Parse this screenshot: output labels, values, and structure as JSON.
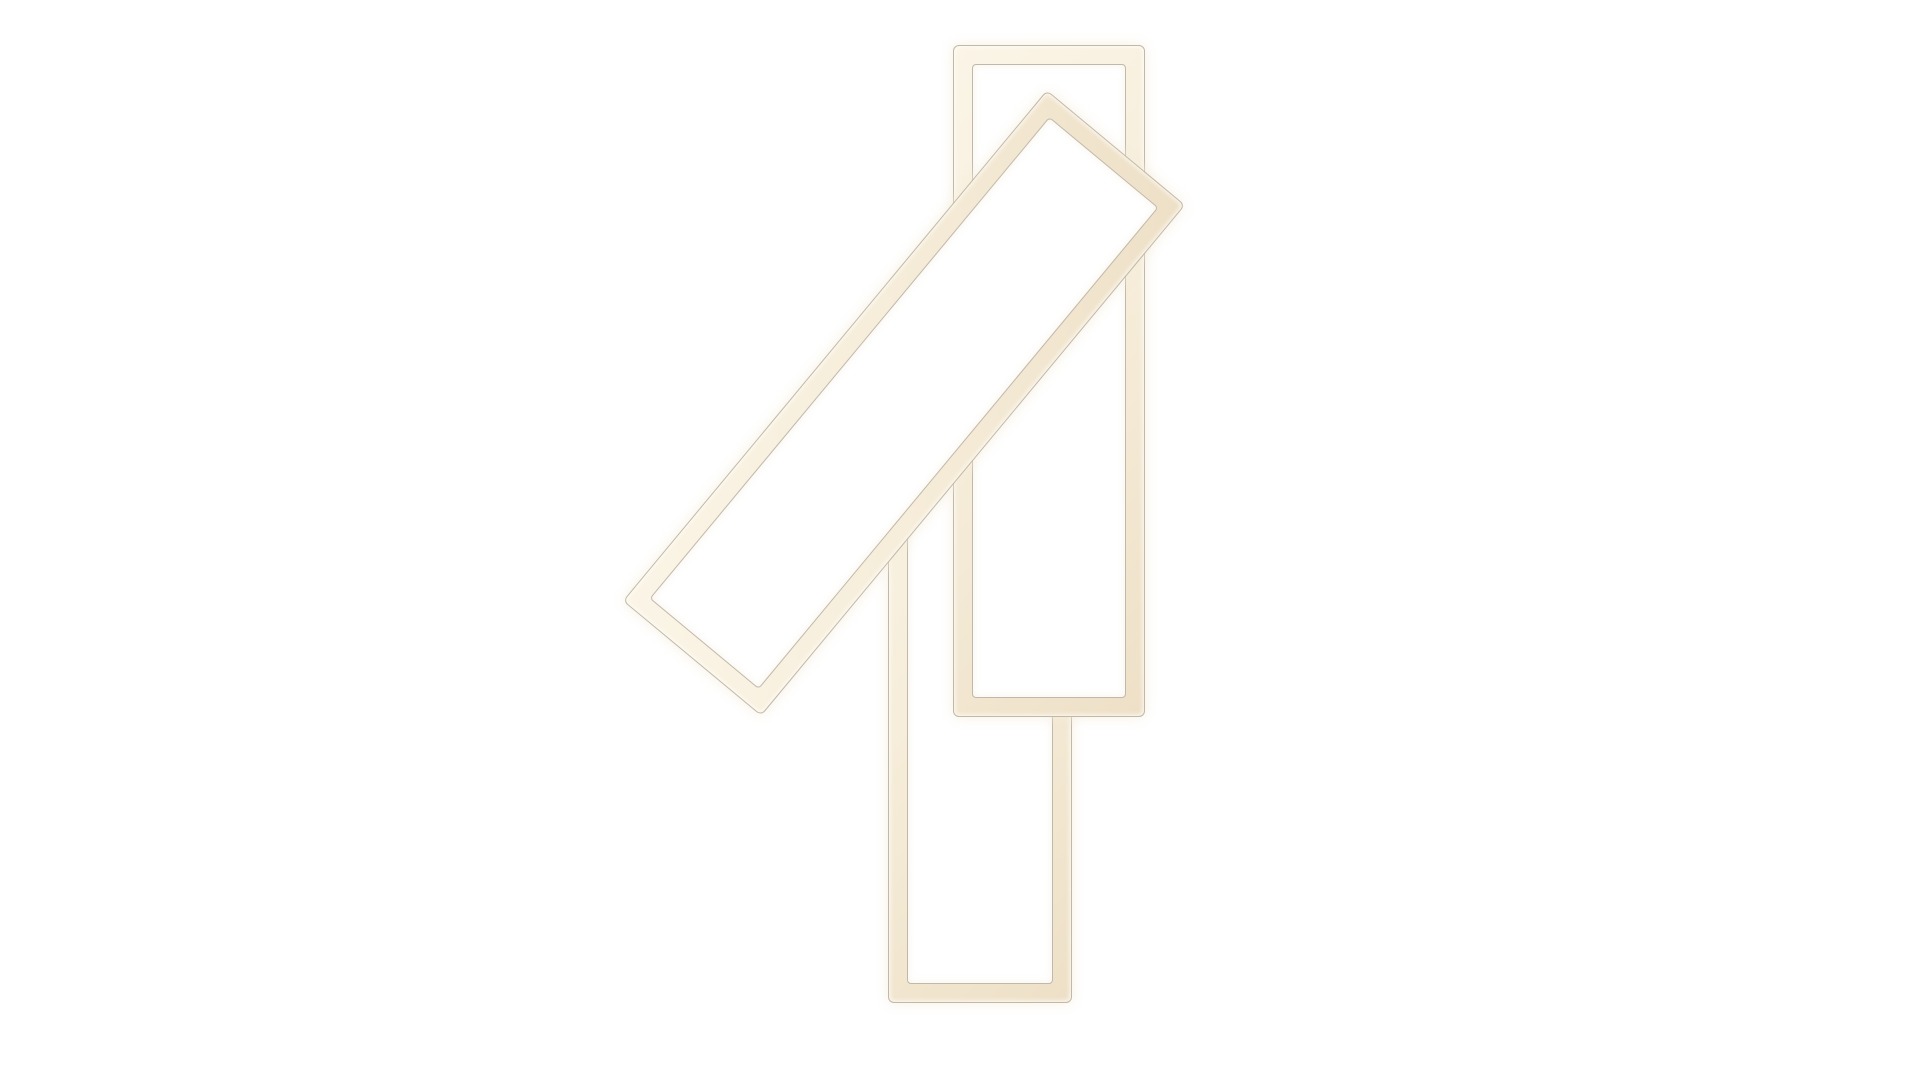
{
  "meta": {
    "type": "product-photograph",
    "subject": "LED ceiling lamp with three rectangular light frames on a brushed aluminium canopy",
    "background": "#ffffff"
  },
  "colors": {
    "background": "#ffffff",
    "tube_fill": "#f6edda",
    "tube_fill_bright": "#fbf5e7",
    "tube_fill_shade": "#eee0c7",
    "tube_outline": "#c0b8aa",
    "plate_light": "#c9cdd2",
    "plate_mid": "#b4bac0",
    "plate_dark": "#a5abb2",
    "plate_outline": "#969ca3",
    "panel_fill": "#f7f0dd",
    "panel_fill_deep": "#f1e7d0",
    "panel_outline": "#d3c8b2",
    "screw_dark": "#332e28",
    "screw_light": "#6e675d"
  },
  "frames": [
    {
      "id": "upper-vertical",
      "x": 953,
      "y": 45,
      "width": 192,
      "height": 672,
      "rotation_deg": 0,
      "tube_px": 18,
      "z": 4
    },
    {
      "id": "lower-vertical",
      "x": 888,
      "y": 334,
      "width": 184,
      "height": 669,
      "rotation_deg": 0,
      "tube_px": 18,
      "z": 3
    },
    {
      "id": "diagonal",
      "x": 572,
      "y": 313,
      "width": 664,
      "height": 180,
      "rotation_deg": -50.3,
      "tube_px": 18,
      "z": 5
    }
  ],
  "mount": {
    "plate": {
      "x": 972,
      "y": 404,
      "width": 91,
      "height": 240
    },
    "panel": {
      "x": 988,
      "y": 468,
      "width": 56,
      "height": 117
    },
    "screw": {
      "cx": 1019,
      "cy": 425,
      "r": 5
    }
  }
}
